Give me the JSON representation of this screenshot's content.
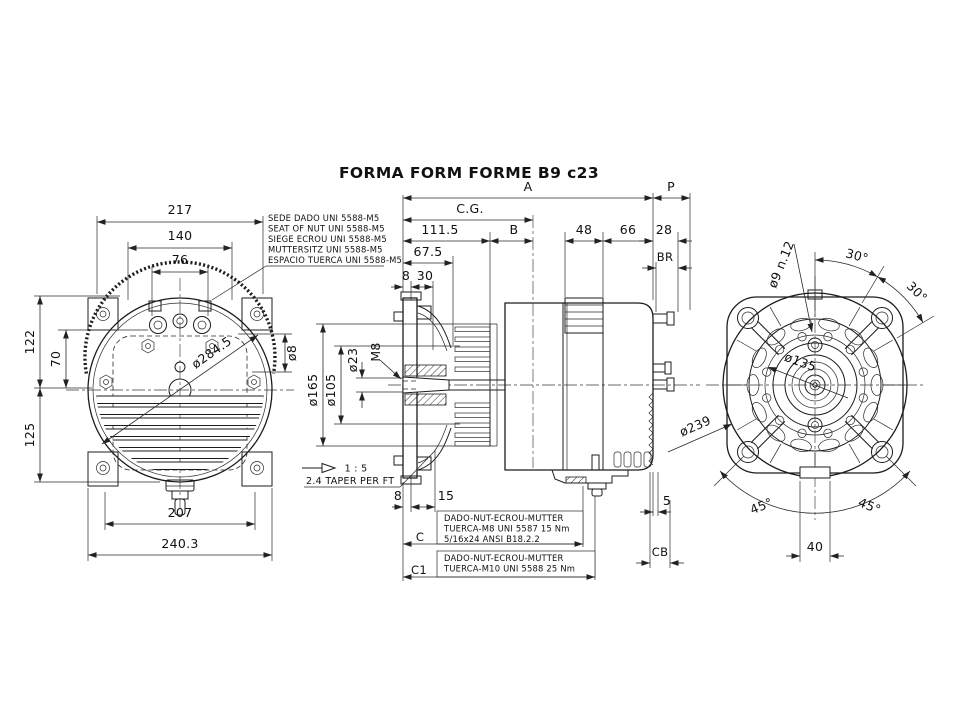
{
  "title": "FORMA FORM FORME B9 c23",
  "front_view": {
    "dims": {
      "w217": "217",
      "w140": "140",
      "w76": "76",
      "h122": "122",
      "h70": "70",
      "h125": "125",
      "w207": "207",
      "w240": "240.3",
      "d284": "ø284.5",
      "d8": "ø8"
    },
    "nut_note": [
      "SEDE DADO UNI 5588-M5",
      "SEAT OF NUT UNI 5588-M5",
      "SIEGE ECROU UNI 5588-M5",
      "MUTTERSITZ UNI 5588-M5",
      "ESPACIO TUERCA UNI 5588-M5"
    ]
  },
  "section_view": {
    "dims": {
      "A": "A",
      "P": "P",
      "CG": "C.G.",
      "B": "B",
      "l111": "111.5",
      "l48": "48",
      "l66": "66",
      "l28": "28",
      "BR": "BR",
      "l67": "67.5",
      "t8": "8",
      "l30": "30",
      "d23": "ø23",
      "m8": "M8",
      "d165": "ø165",
      "d105": "ø105",
      "b8": "8",
      "l15": "15",
      "l5": "5",
      "CB": "CB",
      "C": "C",
      "C1": "C1"
    },
    "taper": {
      "ratio": "1 : 5",
      "note": "2.4 TAPER PER FT"
    },
    "note_C": [
      "DADO-NUT-ECROU-MUTTER",
      "TUERCA-M8 UNI 5587 15 Nm",
      "5/16x24 ANSI B18.2.2"
    ],
    "note_C1": [
      "DADO-NUT-ECROU-MUTTER",
      "TUERCA-M10 UNI 5588 25 Nm"
    ]
  },
  "end_view": {
    "dims": {
      "holes": "ø9 n.12",
      "a30a": "30°",
      "a30b": "30°",
      "d135": "ø135",
      "d239": "ø239",
      "a45a": "45°",
      "a45b": "45°",
      "l40": "40"
    }
  }
}
